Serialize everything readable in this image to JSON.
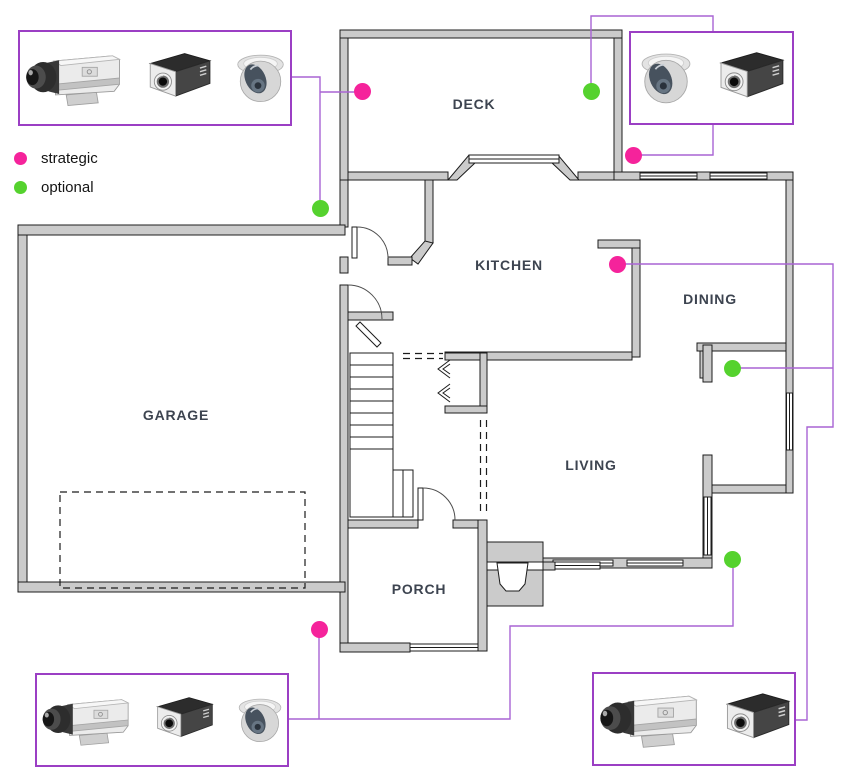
{
  "legend": {
    "items": [
      {
        "id": "strategic",
        "label": "strategic"
      },
      {
        "id": "optional",
        "label": "optional"
      }
    ]
  },
  "colors": {
    "strategic": "#f5239b",
    "optional": "#55d22e",
    "connector": "#a964d4",
    "box_border": "#9b3fc4",
    "wall_fill": "#cbcbcb",
    "wall_stroke": "#1c1c1c",
    "room_label_text": "#3d4450",
    "legend_text": "#141414"
  },
  "rooms": [
    {
      "name": "DECK",
      "x": 474,
      "y": 104
    },
    {
      "name": "KITCHEN",
      "x": 509,
      "y": 265
    },
    {
      "name": "DINING",
      "x": 710,
      "y": 299
    },
    {
      "name": "GARAGE",
      "x": 176,
      "y": 415
    },
    {
      "name": "LIVING",
      "x": 591,
      "y": 465
    },
    {
      "name": "PORCH",
      "x": 419,
      "y": 589
    }
  ],
  "camera_boxes": [
    {
      "id": "top-left",
      "x": 18,
      "y": 30,
      "w": 274,
      "h": 96,
      "cameras": [
        "bullet",
        "compact",
        "dome"
      ]
    },
    {
      "id": "top-right",
      "x": 629,
      "y": 31,
      "w": 165,
      "h": 94,
      "cameras": [
        "dome",
        "compact"
      ]
    },
    {
      "id": "bottom-left",
      "x": 35,
      "y": 673,
      "w": 254,
      "h": 94,
      "cameras": [
        "bullet",
        "compact",
        "dome"
      ]
    },
    {
      "id": "bottom-right",
      "x": 592,
      "y": 672,
      "w": 204,
      "h": 94,
      "cameras": [
        "bullet",
        "compact"
      ]
    }
  ],
  "camera_icon_names": {
    "bullet": "box-camera-side-icon",
    "compact": "box-camera-front-icon",
    "dome": "dome-camera-icon"
  },
  "placements": [
    {
      "id": "deck-left",
      "type": "strategic",
      "x": 362,
      "y": 91
    },
    {
      "id": "deck-corner",
      "type": "strategic",
      "x": 633,
      "y": 155
    },
    {
      "id": "kitchen",
      "type": "strategic",
      "x": 617,
      "y": 264
    },
    {
      "id": "porch",
      "type": "strategic",
      "x": 319,
      "y": 629
    },
    {
      "id": "deck-right",
      "type": "optional",
      "x": 591,
      "y": 91
    },
    {
      "id": "garage-corner",
      "type": "optional",
      "x": 320,
      "y": 208
    },
    {
      "id": "dining",
      "type": "optional",
      "x": 732,
      "y": 368
    },
    {
      "id": "living",
      "type": "optional",
      "x": 732,
      "y": 559
    }
  ],
  "connections": [
    {
      "id": "tl-box-to-garage-dot",
      "points": [
        [
          292,
          77
        ],
        [
          320,
          77
        ],
        [
          320,
          208
        ]
      ]
    },
    {
      "id": "tl-branch-to-deck-dot",
      "points": [
        [
          320,
          92
        ],
        [
          362,
          92
        ]
      ]
    },
    {
      "id": "deckright-to-tr-box",
      "points": [
        [
          591,
          91
        ],
        [
          591,
          16
        ],
        [
          713,
          16
        ],
        [
          713,
          31
        ]
      ]
    },
    {
      "id": "corner-dot-to-tr-box",
      "points": [
        [
          633,
          155
        ],
        [
          713,
          155
        ],
        [
          713,
          125
        ]
      ]
    },
    {
      "id": "kitchen-to-br-box",
      "points": [
        [
          617,
          264
        ],
        [
          833,
          264
        ],
        [
          833,
          427
        ],
        [
          807,
          427
        ],
        [
          807,
          720
        ],
        [
          796,
          720
        ]
      ]
    },
    {
      "id": "dining-to-right-line",
      "points": [
        [
          732,
          368
        ],
        [
          833,
          368
        ]
      ]
    },
    {
      "id": "bl-box-to-living-dot",
      "points": [
        [
          289,
          719
        ],
        [
          510,
          719
        ],
        [
          510,
          626
        ],
        [
          733,
          626
        ],
        [
          733,
          559
        ]
      ]
    },
    {
      "id": "porch-dot-drop",
      "points": [
        [
          319,
          629
        ],
        [
          319,
          719
        ]
      ]
    }
  ]
}
